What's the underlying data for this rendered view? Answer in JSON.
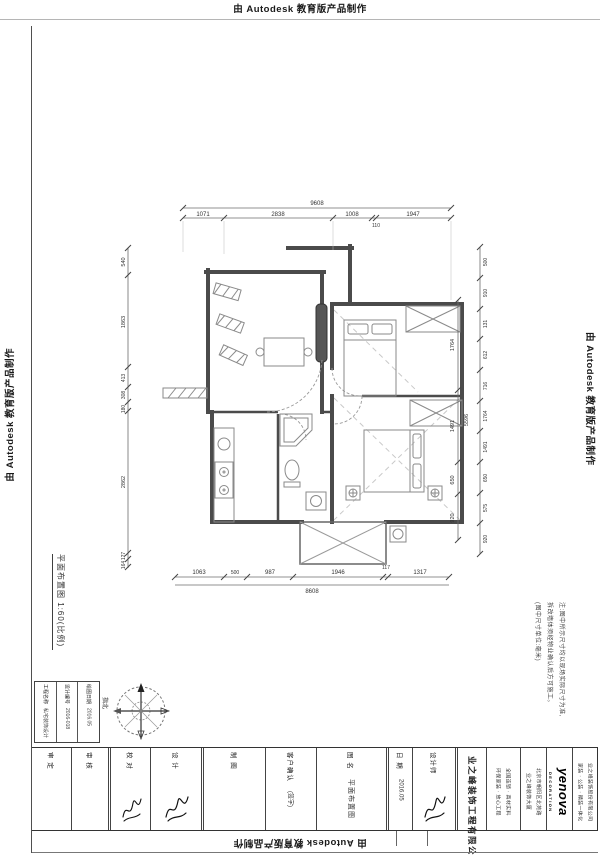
{
  "watermark": {
    "text": "由 Autodesk 教育版产品制作"
  },
  "plan": {
    "scale_label": "平面布置图 1:60(比例)",
    "dims": {
      "top": {
        "overall": "9608",
        "segments": [
          "1071",
          "2838",
          "1008",
          "110",
          "1947"
        ]
      },
      "bottom": {
        "overall": "8608",
        "segments": [
          "1063",
          "500",
          "987",
          "1946",
          "117",
          "1317"
        ]
      },
      "left": {
        "segments": [
          "540",
          "1863",
          "413",
          "308",
          "180",
          "2862",
          "127",
          "164"
        ]
      },
      "right": {
        "overall": "5596",
        "inner": [
          "1764",
          "1491",
          "650",
          "920"
        ],
        "outer": [
          "500",
          "910",
          "131",
          "612",
          "716",
          "1764",
          "1491",
          "650",
          "575",
          "920"
        ]
      }
    }
  },
  "notes": {
    "lines": [
      "注:图中所示尺寸均以现场实际尺寸为准,",
      "拆改墙体须经物业确认后方可施工。",
      "(图中尺寸单位:毫米)"
    ]
  },
  "titleblock": {
    "compass_label": "指北",
    "small_table": {
      "cols": [
        {
          "label": "工程名称",
          "value": "私宅装饰设计"
        },
        {
          "label": "设计编号",
          "value": "2016-018"
        },
        {
          "label": "绘图日期",
          "value": "2016.05"
        }
      ]
    },
    "columns": [
      {
        "label": "审 定",
        "value": ""
      },
      {
        "label": "审 核",
        "value": ""
      },
      {
        "label": "校 对",
        "value": ""
      },
      {
        "label": "设 计",
        "value": ""
      },
      {
        "label": "制 图",
        "value": ""
      },
      {
        "label": "客户确认",
        "value": "(签字)"
      },
      {
        "label": "图 名",
        "value": "平面布置图"
      },
      {
        "label": "日 期",
        "value": "2016.05"
      },
      {
        "label": "设计师",
        "value": ""
      },
      {
        "company": "业之峰装饰工程有限公司"
      },
      {
        "lines": [
          "全国连锁 · 真材实料",
          "环保家装 · 放心工程"
        ]
      },
      {
        "lines": [
          "北京市朝阳区北苑路",
          "业之峰装饰大厦"
        ]
      },
      {
        "brand": "yenova",
        "brand_sub": "DECORATION"
      },
      {
        "lines": [
          "业之峰装饰股份有限公司",
          "家装 · 公装 · 精装一体化"
        ]
      }
    ]
  }
}
